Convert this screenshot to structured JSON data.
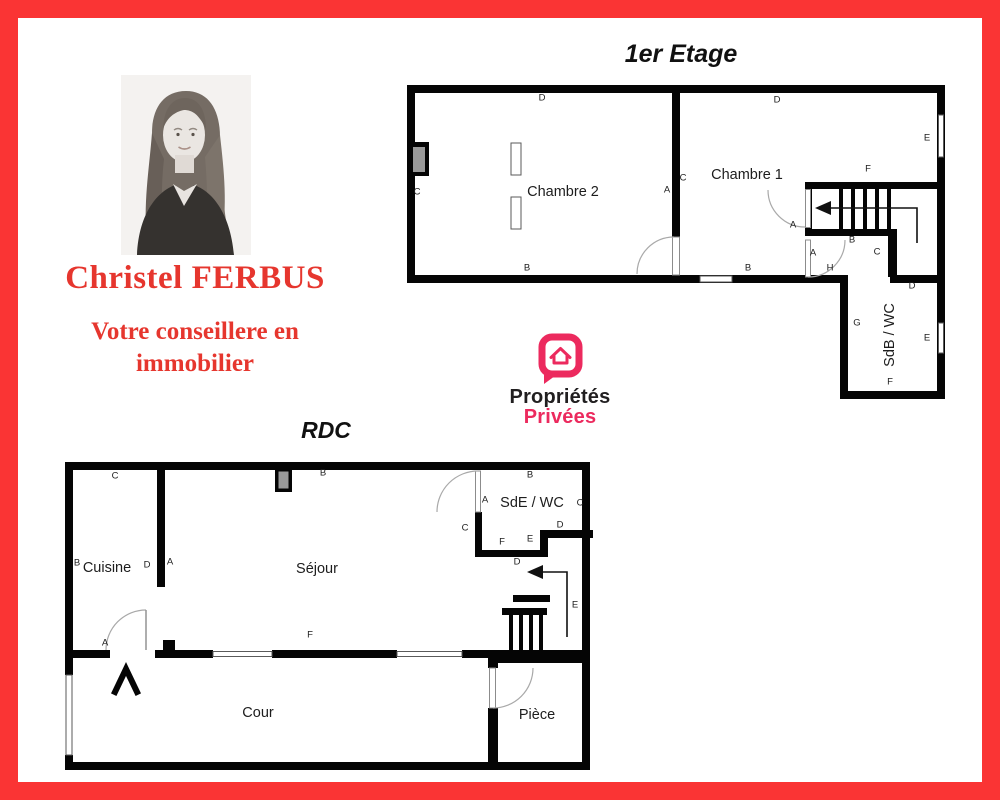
{
  "frame": {
    "color": "#fa3434"
  },
  "agent": {
    "name": "Christel FERBUS",
    "tagline_line1": "Votre conseillere en",
    "tagline_line2": "immobilier",
    "text_color": "#e6362e",
    "photo_icon": "woman-portrait-grayscale"
  },
  "logo": {
    "word1": "Propriétés",
    "word2": "Privées",
    "pink": "#ec2a5e",
    "black": "#211f20",
    "icon": "house-speech-bubble-icon"
  },
  "floor1": {
    "title": "1er Etage",
    "room_labels": [
      {
        "text": "Chambre 2",
        "x": 160,
        "y": 109
      },
      {
        "text": "Chambre 1",
        "x": 344,
        "y": 92
      }
    ],
    "vertical_labels": [
      {
        "text": "SdB / WC",
        "x": 487,
        "y": 252
      }
    ],
    "wall_labels": [
      {
        "text": "D",
        "x": 139,
        "y": 15
      },
      {
        "text": "D",
        "x": 374,
        "y": 17
      },
      {
        "text": "C",
        "x": 14,
        "y": 109
      },
      {
        "text": "A",
        "x": 264,
        "y": 107
      },
      {
        "text": "C",
        "x": 280,
        "y": 95
      },
      {
        "text": "B",
        "x": 124,
        "y": 185
      },
      {
        "text": "B",
        "x": 345,
        "y": 185
      },
      {
        "text": "E",
        "x": 524,
        "y": 55
      },
      {
        "text": "F",
        "x": 465,
        "y": 86
      },
      {
        "text": "A",
        "x": 390,
        "y": 142
      },
      {
        "text": "A",
        "x": 410,
        "y": 170
      },
      {
        "text": "H",
        "x": 427,
        "y": 185
      },
      {
        "text": "B",
        "x": 449,
        "y": 157
      },
      {
        "text": "C",
        "x": 474,
        "y": 169
      },
      {
        "text": "D",
        "x": 509,
        "y": 203
      },
      {
        "text": "G",
        "x": 454,
        "y": 240
      },
      {
        "text": "E",
        "x": 524,
        "y": 255
      },
      {
        "text": "F",
        "x": 487,
        "y": 299
      }
    ]
  },
  "rdc": {
    "title": "RDC",
    "room_labels": [
      {
        "text": "Cuisine",
        "x": 44,
        "y": 108
      },
      {
        "text": "Séjour",
        "x": 254,
        "y": 109
      },
      {
        "text": "SdE / WC",
        "x": 469,
        "y": 43
      },
      {
        "text": "Cour",
        "x": 195,
        "y": 253
      },
      {
        "text": "Pièce",
        "x": 474,
        "y": 255
      }
    ],
    "vertical_labels": [],
    "wall_labels": [
      {
        "text": "C",
        "x": 52,
        "y": 16
      },
      {
        "text": "B",
        "x": 14,
        "y": 103
      },
      {
        "text": "D",
        "x": 84,
        "y": 105
      },
      {
        "text": "A",
        "x": 107,
        "y": 102
      },
      {
        "text": "B",
        "x": 260,
        "y": 13
      },
      {
        "text": "F",
        "x": 247,
        "y": 175
      },
      {
        "text": "A",
        "x": 42,
        "y": 183
      },
      {
        "text": "B",
        "x": 467,
        "y": 15
      },
      {
        "text": "A",
        "x": 422,
        "y": 40
      },
      {
        "text": "C",
        "x": 517,
        "y": 43
      },
      {
        "text": "D",
        "x": 497,
        "y": 65
      },
      {
        "text": "E",
        "x": 467,
        "y": 79
      },
      {
        "text": "F",
        "x": 439,
        "y": 82
      },
      {
        "text": "C",
        "x": 402,
        "y": 68
      },
      {
        "text": "D",
        "x": 454,
        "y": 102
      },
      {
        "text": "E",
        "x": 512,
        "y": 145
      }
    ]
  }
}
